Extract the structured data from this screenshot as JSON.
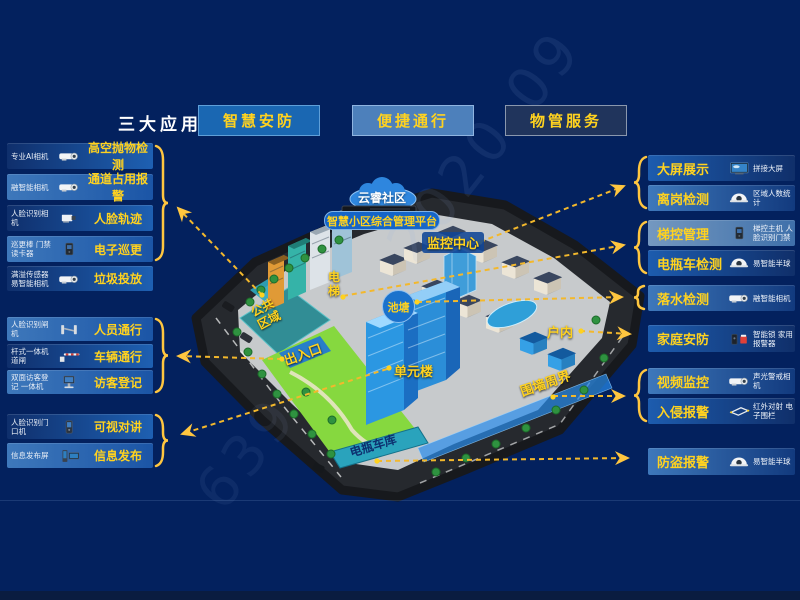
{
  "header": {
    "title": "三大应用",
    "buttons": [
      {
        "label": "智慧安防"
      },
      {
        "label": "便捷通行"
      },
      {
        "label": "物管服务"
      }
    ]
  },
  "left_panel": {
    "groups": [
      {
        "rows": [
          {
            "device": "专业AI相机",
            "icon": "bullet-camera",
            "label": "高空抛物检测"
          },
          {
            "device": "融智能相机",
            "icon": "bullet-camera",
            "label": "通道占用报警"
          },
          {
            "device": "人脸识别相机",
            "icon": "box-camera",
            "label": "人脸轨迹"
          },
          {
            "device": "巡更棒 门禁读卡器",
            "icon": "card-reader",
            "label": "电子巡更"
          }
        ]
      },
      {
        "rows": [
          {
            "device": "满溢传感器 易智能相机",
            "icon": "bullet-camera",
            "label": "垃圾投放"
          }
        ]
      },
      {
        "rows": [
          {
            "device": "人脸识别闸机",
            "icon": "turnstile",
            "label": "人员通行"
          },
          {
            "device": "杆式一体机 道闸",
            "icon": "barrier-gate",
            "label": "车辆通行"
          },
          {
            "device": "双面访客登记 一体机",
            "icon": "visitor-kiosk",
            "label": "访客登记"
          }
        ]
      },
      {
        "rows": [
          {
            "device": "人脸识别门口机",
            "icon": "door-station",
            "label": "可视对讲"
          },
          {
            "device": "信息发布屏",
            "icon": "signage-screen",
            "label": "信息发布"
          }
        ]
      }
    ]
  },
  "right_panel": {
    "groups": [
      {
        "rows": [
          {
            "label": "大屏展示",
            "icon": "video-wall",
            "device": "拼接大屏"
          },
          {
            "label": "离岗检测",
            "icon": "dome-camera",
            "device": "区域人数统计"
          }
        ]
      },
      {
        "rows": [
          {
            "label": "梯控管理",
            "icon": "elevator-panel",
            "device": "梯控主机 人脸识别门禁"
          },
          {
            "label": "电瓶车检测",
            "icon": "dome-camera",
            "device": "易智能半球"
          }
        ]
      },
      {
        "rows": [
          {
            "label": "落水检测",
            "icon": "bullet-camera",
            "device": "融智能相机"
          }
        ]
      },
      {
        "rows": [
          {
            "label": "家庭安防",
            "icon": "smart-lock-siren",
            "device": "智能锁 家用报警器"
          }
        ]
      },
      {
        "rows": [
          {
            "label": "视频监控",
            "icon": "bullet-camera",
            "device": "声光警戒相机"
          },
          {
            "label": "入侵报警",
            "icon": "perimeter-beam",
            "device": "红外对射 电子围栏"
          }
        ]
      },
      {
        "rows": [
          {
            "label": "防盗报警",
            "icon": "dome-camera",
            "device": "易智能半球"
          }
        ]
      }
    ]
  },
  "map": {
    "cloud": "云睿社区",
    "platform": "智慧小区综合管理平台",
    "labels": {
      "monitor_center": "监控中心",
      "elevator": "电梯",
      "pond": "池塘",
      "public_area": "公共区域",
      "entrance": "出入口",
      "unit_building": "单元楼",
      "indoor": "户内",
      "perimeter": "围墙周界",
      "bike_garage": "电瓶车库"
    }
  },
  "watermark": {
    "text1": "2020-09",
    "text2": "639"
  },
  "colors": {
    "background": "#03215e",
    "accent_yellow": "#ffd21f",
    "arrow_yellow": "#f3b82c",
    "row_blue": "#1e60b2",
    "button_blue": "#1a67b2"
  }
}
